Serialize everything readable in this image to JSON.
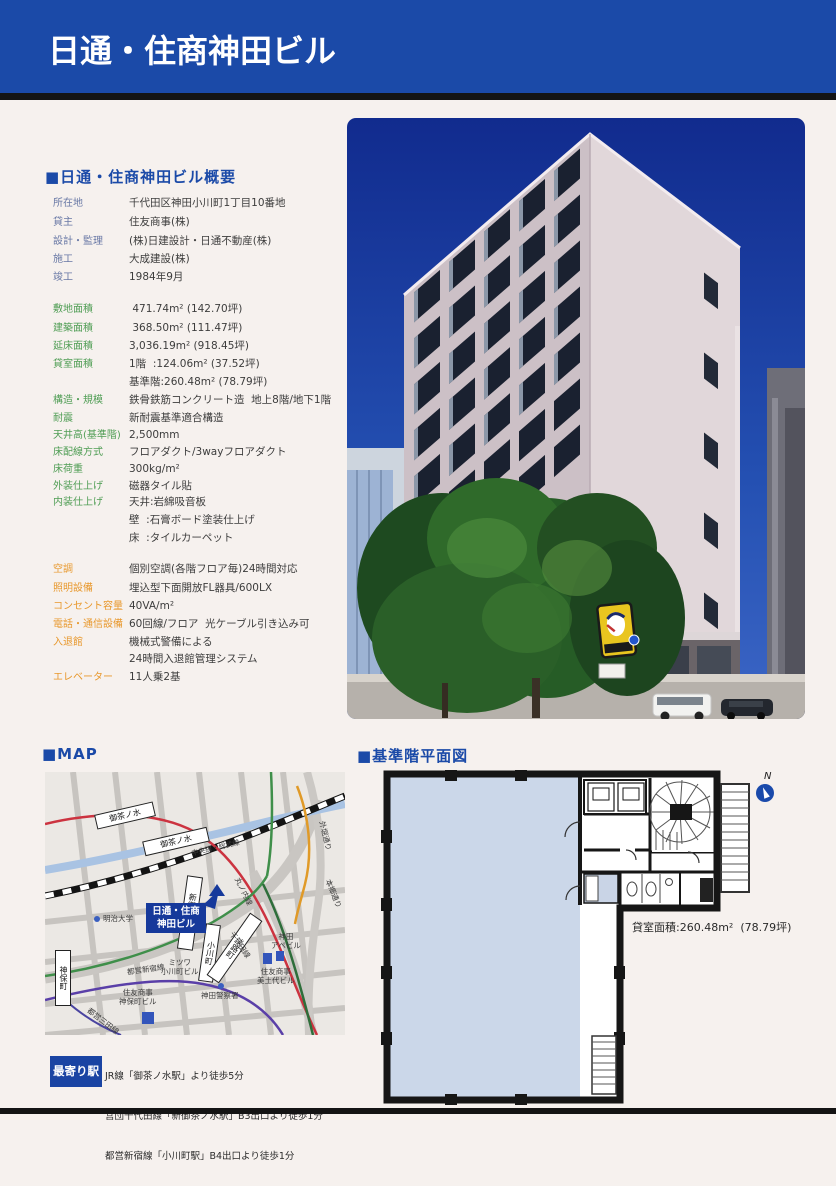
{
  "header": {
    "title": "日通・住商神田ビル"
  },
  "overview": {
    "heading": "■日通・住商神田ビル概要",
    "basic": [
      {
        "label": "所在地",
        "value": "千代田区神田小川町1丁目10番地"
      },
      {
        "label": "貸主",
        "value": "住友商事(株)"
      },
      {
        "label": "設計・監理",
        "value": "(株)日建設計・日通不動産(株)"
      },
      {
        "label": "施工",
        "value": "大成建設(株)"
      },
      {
        "label": "竣工",
        "value": "1984年9月"
      }
    ],
    "areas": [
      {
        "label": "敷地面積",
        "value": " 471.74m² (142.70坪)"
      },
      {
        "label": "建築面積",
        "value": " 368.50m² (111.47坪)"
      },
      {
        "label": "延床面積",
        "value": "3,036.19m² (918.45坪)"
      },
      {
        "label": "貸室面積",
        "value": "1階  :124.06m² (37.52坪)"
      },
      {
        "label": "",
        "value": "基準階:260.48m² (78.79坪)"
      }
    ],
    "structure": [
      {
        "label": "構造・規模",
        "value": "鉄骨鉄筋コンクリート造  地上8階/地下1階"
      },
      {
        "label": "耐震",
        "value": "新耐震基準適合構造"
      },
      {
        "label": "天井高(基準階)",
        "value": "2,500mm"
      },
      {
        "label": "床配線方式",
        "value": "フロアダクト/3wayフロアダクト"
      },
      {
        "label": "床荷重",
        "value": "300kg/m²"
      },
      {
        "label": "外装仕上げ",
        "value": "磁器タイル貼"
      },
      {
        "label": "内装仕上げ",
        "value": "天井:岩綿吸音板"
      },
      {
        "label": "",
        "value": "壁  :石膏ボード塗装仕上げ"
      },
      {
        "label": "",
        "value": "床  :タイルカーペット"
      }
    ],
    "facilities": [
      {
        "label": "空調",
        "value": "個別空調(各階フロア毎)24時間対応"
      },
      {
        "label": "照明設備",
        "value": "埋込型下面開放FL器具/600LX"
      },
      {
        "label": "コンセント容量",
        "value": "40VA/m²"
      },
      {
        "label": "電話・通信設備",
        "value": "60回線/フロア  光ケーブル引き込み可"
      },
      {
        "label": "入退館",
        "value": "機械式警備による"
      },
      {
        "label": "",
        "value": "24時間入退館管理システム"
      },
      {
        "label": "エレベーター",
        "value": "11人乗2基"
      }
    ]
  },
  "map": {
    "heading": "■MAP",
    "building_box": {
      "line1": "日通・住商",
      "line2": "神田ビル"
    },
    "stations": {
      "ochanomizu_marunouchi": "御茶ノ水",
      "ochanomizu_jr": "御茶ノ水",
      "shin_ochanomizu": "新御茶ノ水",
      "ogawamachi": "小川町",
      "awajicho": "淡路町",
      "jimbocho": "神保町"
    },
    "lines": {
      "chuo_sobu": "中央線・総武線",
      "marunouchi": "丸ノ内線",
      "chiyoda": "千代田線",
      "toei_shinjuku": "都営新宿線",
      "toei_mita": "都営三田線"
    },
    "roads": {
      "yasukuni": "靖国通り",
      "hongo": "本郷通り",
      "sotobori": "外堀通り"
    },
    "places": {
      "meiji": "明治大学",
      "mitsuwa1": "ミツワ",
      "mitsuwa2": "小川町ビル",
      "sumitomo_jimbocho1": "住友商事",
      "sumitomo_jimbocho2": "神保町ビル",
      "police": "神田警察署",
      "midoyo1": "住友商事",
      "midoyo2": "美土代ビル",
      "ape1": "神田",
      "ape2": "アペビル"
    }
  },
  "floorplan": {
    "heading": "■基準階平面図",
    "area_note": "貸室面積:260.48m²  (78.79坪)",
    "north": "N"
  },
  "stations_info": {
    "label": "最寄り駅",
    "lines": [
      "JR線「御茶ノ水駅」より徒歩5分",
      "営団千代田線「新御茶ノ水駅」B3出口より徒歩1分",
      "都営新宿線「小川町駅」B4出口より徒歩1分",
      "営団丸ノ内線「淡路町駅」B4出口より徒歩1分"
    ]
  },
  "colors": {
    "header_blue": "#1b4aa8",
    "label_green": "#4f9d54",
    "label_orange": "#e8982c",
    "map_highlight_blue": "#16399b",
    "rental_area_blue": "#cbd7e9"
  }
}
